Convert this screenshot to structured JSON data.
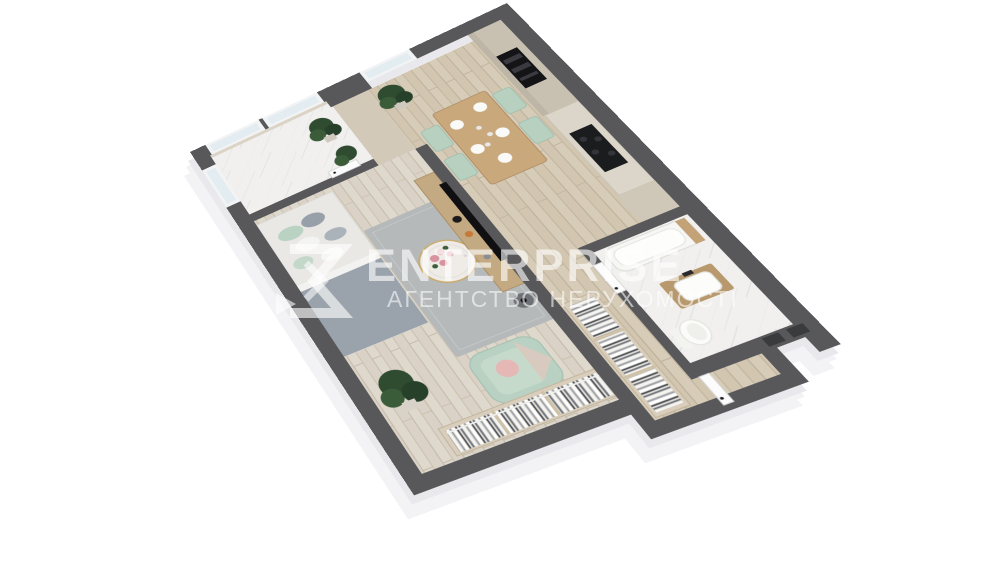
{
  "watermark": {
    "brand": "ENTERPRISE",
    "tagline": "АГЕНТСТВО НЕРУХОМОСТІ",
    "logo": "enterprise-sigma-chevron-logo",
    "color": "#ffffff",
    "opacity": 0.6
  },
  "scene": {
    "type": "3D axonometric floor plan render",
    "background": "#ffffff"
  },
  "palette": {
    "wall_top": "#58585b",
    "wall_side_face": "#f3f3f6",
    "wood_floor": "#d2c6b1",
    "living_floor": "#dad2c6",
    "marble_floor": "#f1f0ee",
    "rug_gray": "#b6b9ba",
    "mint": "#b9d1c2",
    "pink": "#e5b8b5",
    "furniture_wood": "#c4aa82",
    "cabinet_beige": "#c8c0b1",
    "appliance_black": "#141417",
    "plant_green": "#2f4b30"
  },
  "rooms": [
    {
      "name": "balcony",
      "floor": "white-marble",
      "items": [
        "panorama-windows",
        "potted-plant",
        "potted-plant",
        "open-balcony-door"
      ]
    },
    {
      "name": "living-bedroom",
      "floor": "light-wood",
      "items": [
        "double-bed",
        "pillows",
        "gray-rug",
        "round-coffee-table",
        "flower-bouquet",
        "mint-armchair",
        "pink-pillow",
        "potted-plant",
        "open-wardrobe",
        "tv-console",
        "tv",
        "side-table"
      ]
    },
    {
      "name": "kitchen-dining",
      "floor": "wood",
      "items": [
        "tall-cabinets",
        "built-in-oven",
        "kitchen-counter",
        "cooktop",
        "dining-table",
        "mint-chair",
        "mint-chair",
        "mint-chair",
        "mint-chair",
        "plates",
        "potted-plant",
        "kitchen-window"
      ]
    },
    {
      "name": "hallway",
      "floor": "wood",
      "items": [
        "partition-wall",
        "bathroom-door"
      ]
    },
    {
      "name": "entry",
      "floor": "wood",
      "items": [
        "open-wardrobe",
        "entrance-door",
        "wall-vents"
      ]
    },
    {
      "name": "bathroom",
      "floor": "white-marble",
      "items": [
        "bathtub",
        "wood-vanity",
        "sink",
        "toilet"
      ]
    }
  ]
}
